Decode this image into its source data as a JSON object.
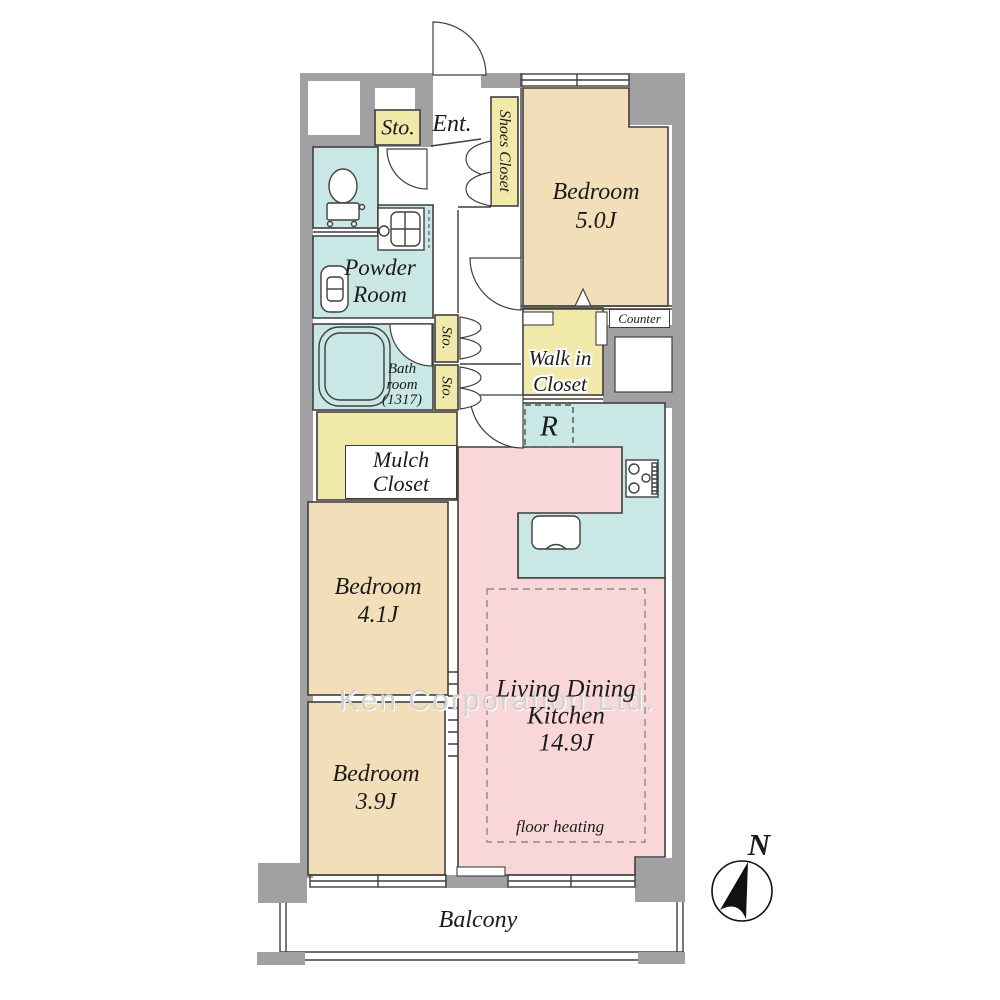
{
  "plan": {
    "labels": {
      "sto_top": "Sto.",
      "ent": "Ent.",
      "shoes_closet": "Shoes Closet",
      "bedroom_1": "Bedroom\n5.0J",
      "powder_room": "Powder\nRoom",
      "bath_room": "Bath\nroom\n(1317)",
      "sto_upper": "Sto.",
      "sto_lower": "Sto.",
      "walk_in_closet": "Walk in\nCloset",
      "counter": "Counter",
      "refrigerator": "R",
      "mulch_closet": "Mulch\nCloset",
      "bedroom_2": "Bedroom\n4.1J",
      "bedroom_3": "Bedroom\n3.9J",
      "ldk": "Living Dining\nKitchen\n14.9J",
      "floor_heating": "floor heating",
      "balcony": "Balcony",
      "compass_north": "N",
      "watermark": "Ken Corporation Ltd."
    },
    "colors": {
      "bedroom": "#f2dfba",
      "ldk": "#f9d7d9",
      "wet": "#c9e7e4",
      "closet": "#f0e9a9",
      "wall": "#a1a1a3",
      "line": "#3f3f3f",
      "watermark": "#d2d2d2"
    }
  }
}
